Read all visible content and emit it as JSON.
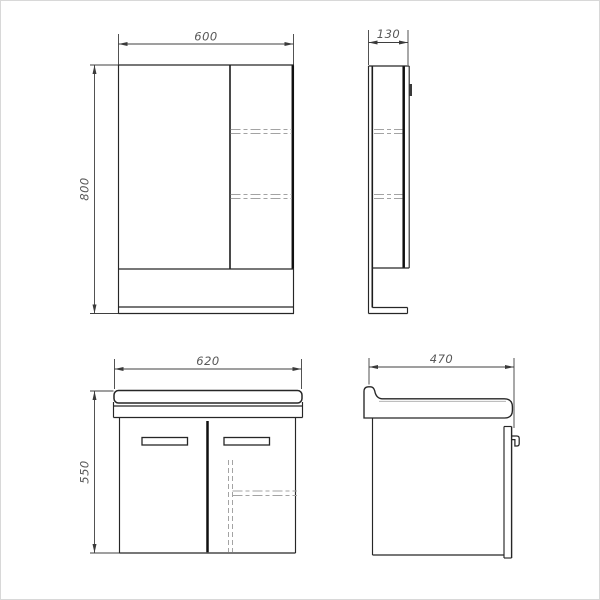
{
  "page": {
    "background": "#ffffff",
    "frame_border": "#d8d8d8",
    "description_labels": {
      "mirror_cabinet_front": "mirror-cabinet-front-view",
      "mirror_cabinet_side": "mirror-cabinet-side-view",
      "vanity_front": "vanity-front-view",
      "vanity_side": "vanity-side-view"
    }
  },
  "drawing": {
    "outline_color": "#262626",
    "thick_line_color": "#101010",
    "hidden_line_color": "#a3a3a3",
    "dimension_line_color": "#3f3f3f",
    "dimension_text_color": "#585858",
    "views": {
      "mirror_cabinet_front": {
        "width_label": "600",
        "height_label": "800"
      },
      "mirror_cabinet_side": {
        "depth_label": "130"
      },
      "vanity_front": {
        "width_label": "620",
        "height_label": "550"
      },
      "vanity_side": {
        "depth_label": "470"
      }
    }
  }
}
